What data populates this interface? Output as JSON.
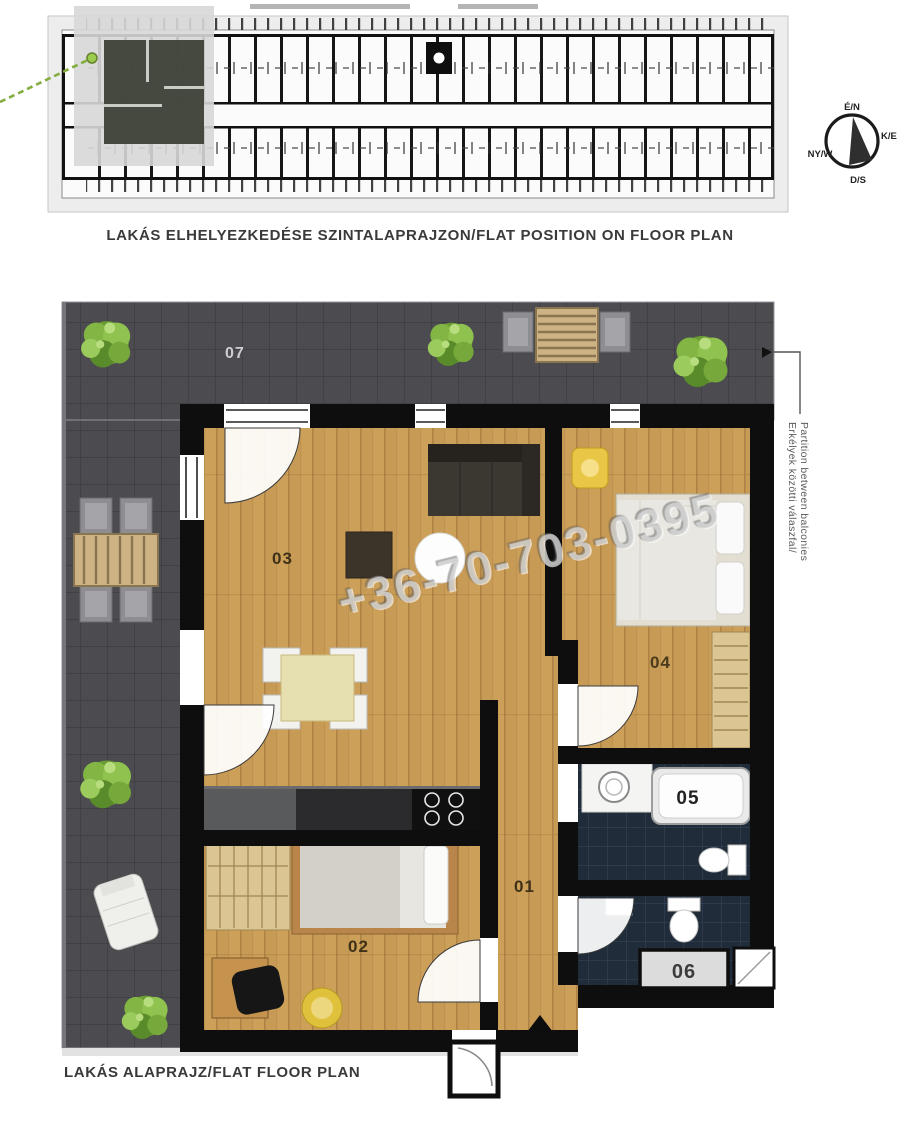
{
  "overview": {
    "caption": "LAKÁS ELHELYEZKEDÉSE SZINTALAPRAJZON/FLAT POSITION ON FLOOR PLAN"
  },
  "compass": {
    "north": "É/N",
    "east": "K/E",
    "west": "NY/W",
    "south": "D/S"
  },
  "plan": {
    "caption": "LAKÁS ALAPRAJZ/FLAT FLOOR PLAN",
    "rooms": {
      "hallway": "01",
      "bedroom2": "02",
      "living_kitchen": "03",
      "bedroom1": "04",
      "bathroom": "05",
      "wc": "06",
      "terrace": "07"
    },
    "balcony_note_hu": "Erkélyek közötti válaszfal/",
    "balcony_note_en": "Partition between balconies"
  },
  "watermark": {
    "phone": "+36-70-703-0395"
  },
  "colors": {
    "terrace_tile": "#4b4b50",
    "wood_floor": "#c79a55",
    "wall": "#0e0e0e",
    "bathroom_tile": "#202c3a",
    "highlight_flat": "#3f4339",
    "callout_green": "#84ad3f"
  }
}
